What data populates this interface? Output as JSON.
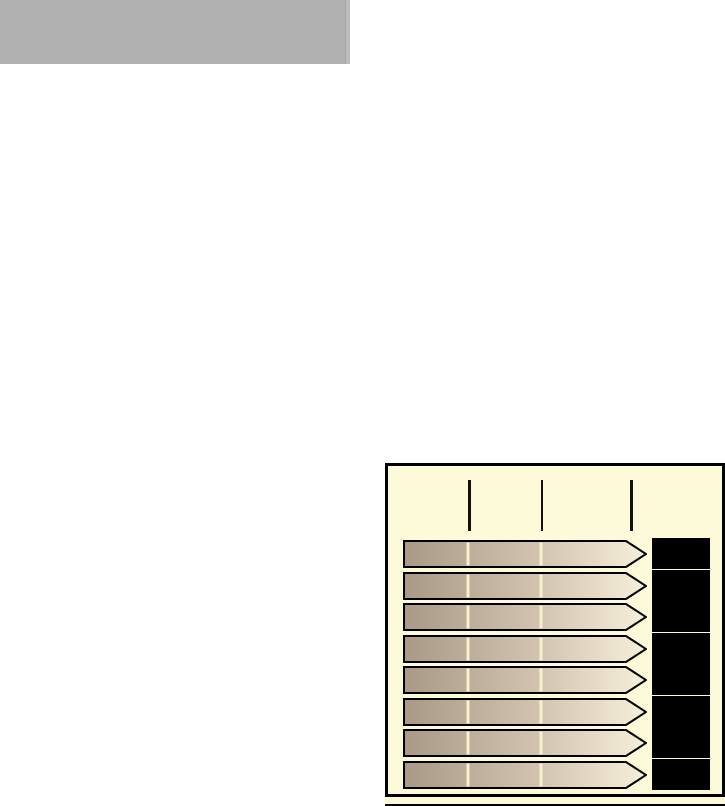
{
  "placeholder": {
    "color": "#b1b1b1",
    "edge_light": "#bcbcbc"
  },
  "chart": {
    "canvas_bg": "#fcfad8",
    "border_color": "#000000",
    "cutoff_strip_color": "#000000"
  },
  "chart_data": {
    "type": "bar",
    "orientation": "horizontal",
    "title": "",
    "categories": [
      "",
      "",
      "",
      "",
      "",
      "",
      "",
      ""
    ],
    "values": [
      100,
      100,
      100,
      100,
      100,
      100,
      100,
      100
    ],
    "value_range": [
      0,
      100
    ],
    "bar_style": "arrow-pentagon",
    "bar_gradient": {
      "start": "#a89a84",
      "mid": "#cdbfa9",
      "end": "#f7efda"
    },
    "bar_outline_color": "#000000",
    "inner_gridline_color": "#f7f1cd",
    "value_boxes": {
      "fill": "#000000",
      "labels_visible": false
    },
    "axis": {
      "tick_count": 3,
      "tick_labels": [
        "",
        "",
        ""
      ],
      "tick_color": "#111111"
    },
    "legend": "none",
    "layout_hints": {
      "first_row_top": 74,
      "row_pitch": 31.57,
      "arrow_left": 15,
      "arrow_max_width": 244,
      "arrow_height": 28,
      "tip_width": 20,
      "box_left": 264,
      "box_width": 58,
      "box_height": 31,
      "ticks": [
        {
          "x": 80,
          "w": 3
        },
        {
          "x": 153,
          "w": 2
        },
        {
          "x": 242,
          "w": 3
        }
      ],
      "tick_top": 14,
      "tick_height": 51
    }
  }
}
